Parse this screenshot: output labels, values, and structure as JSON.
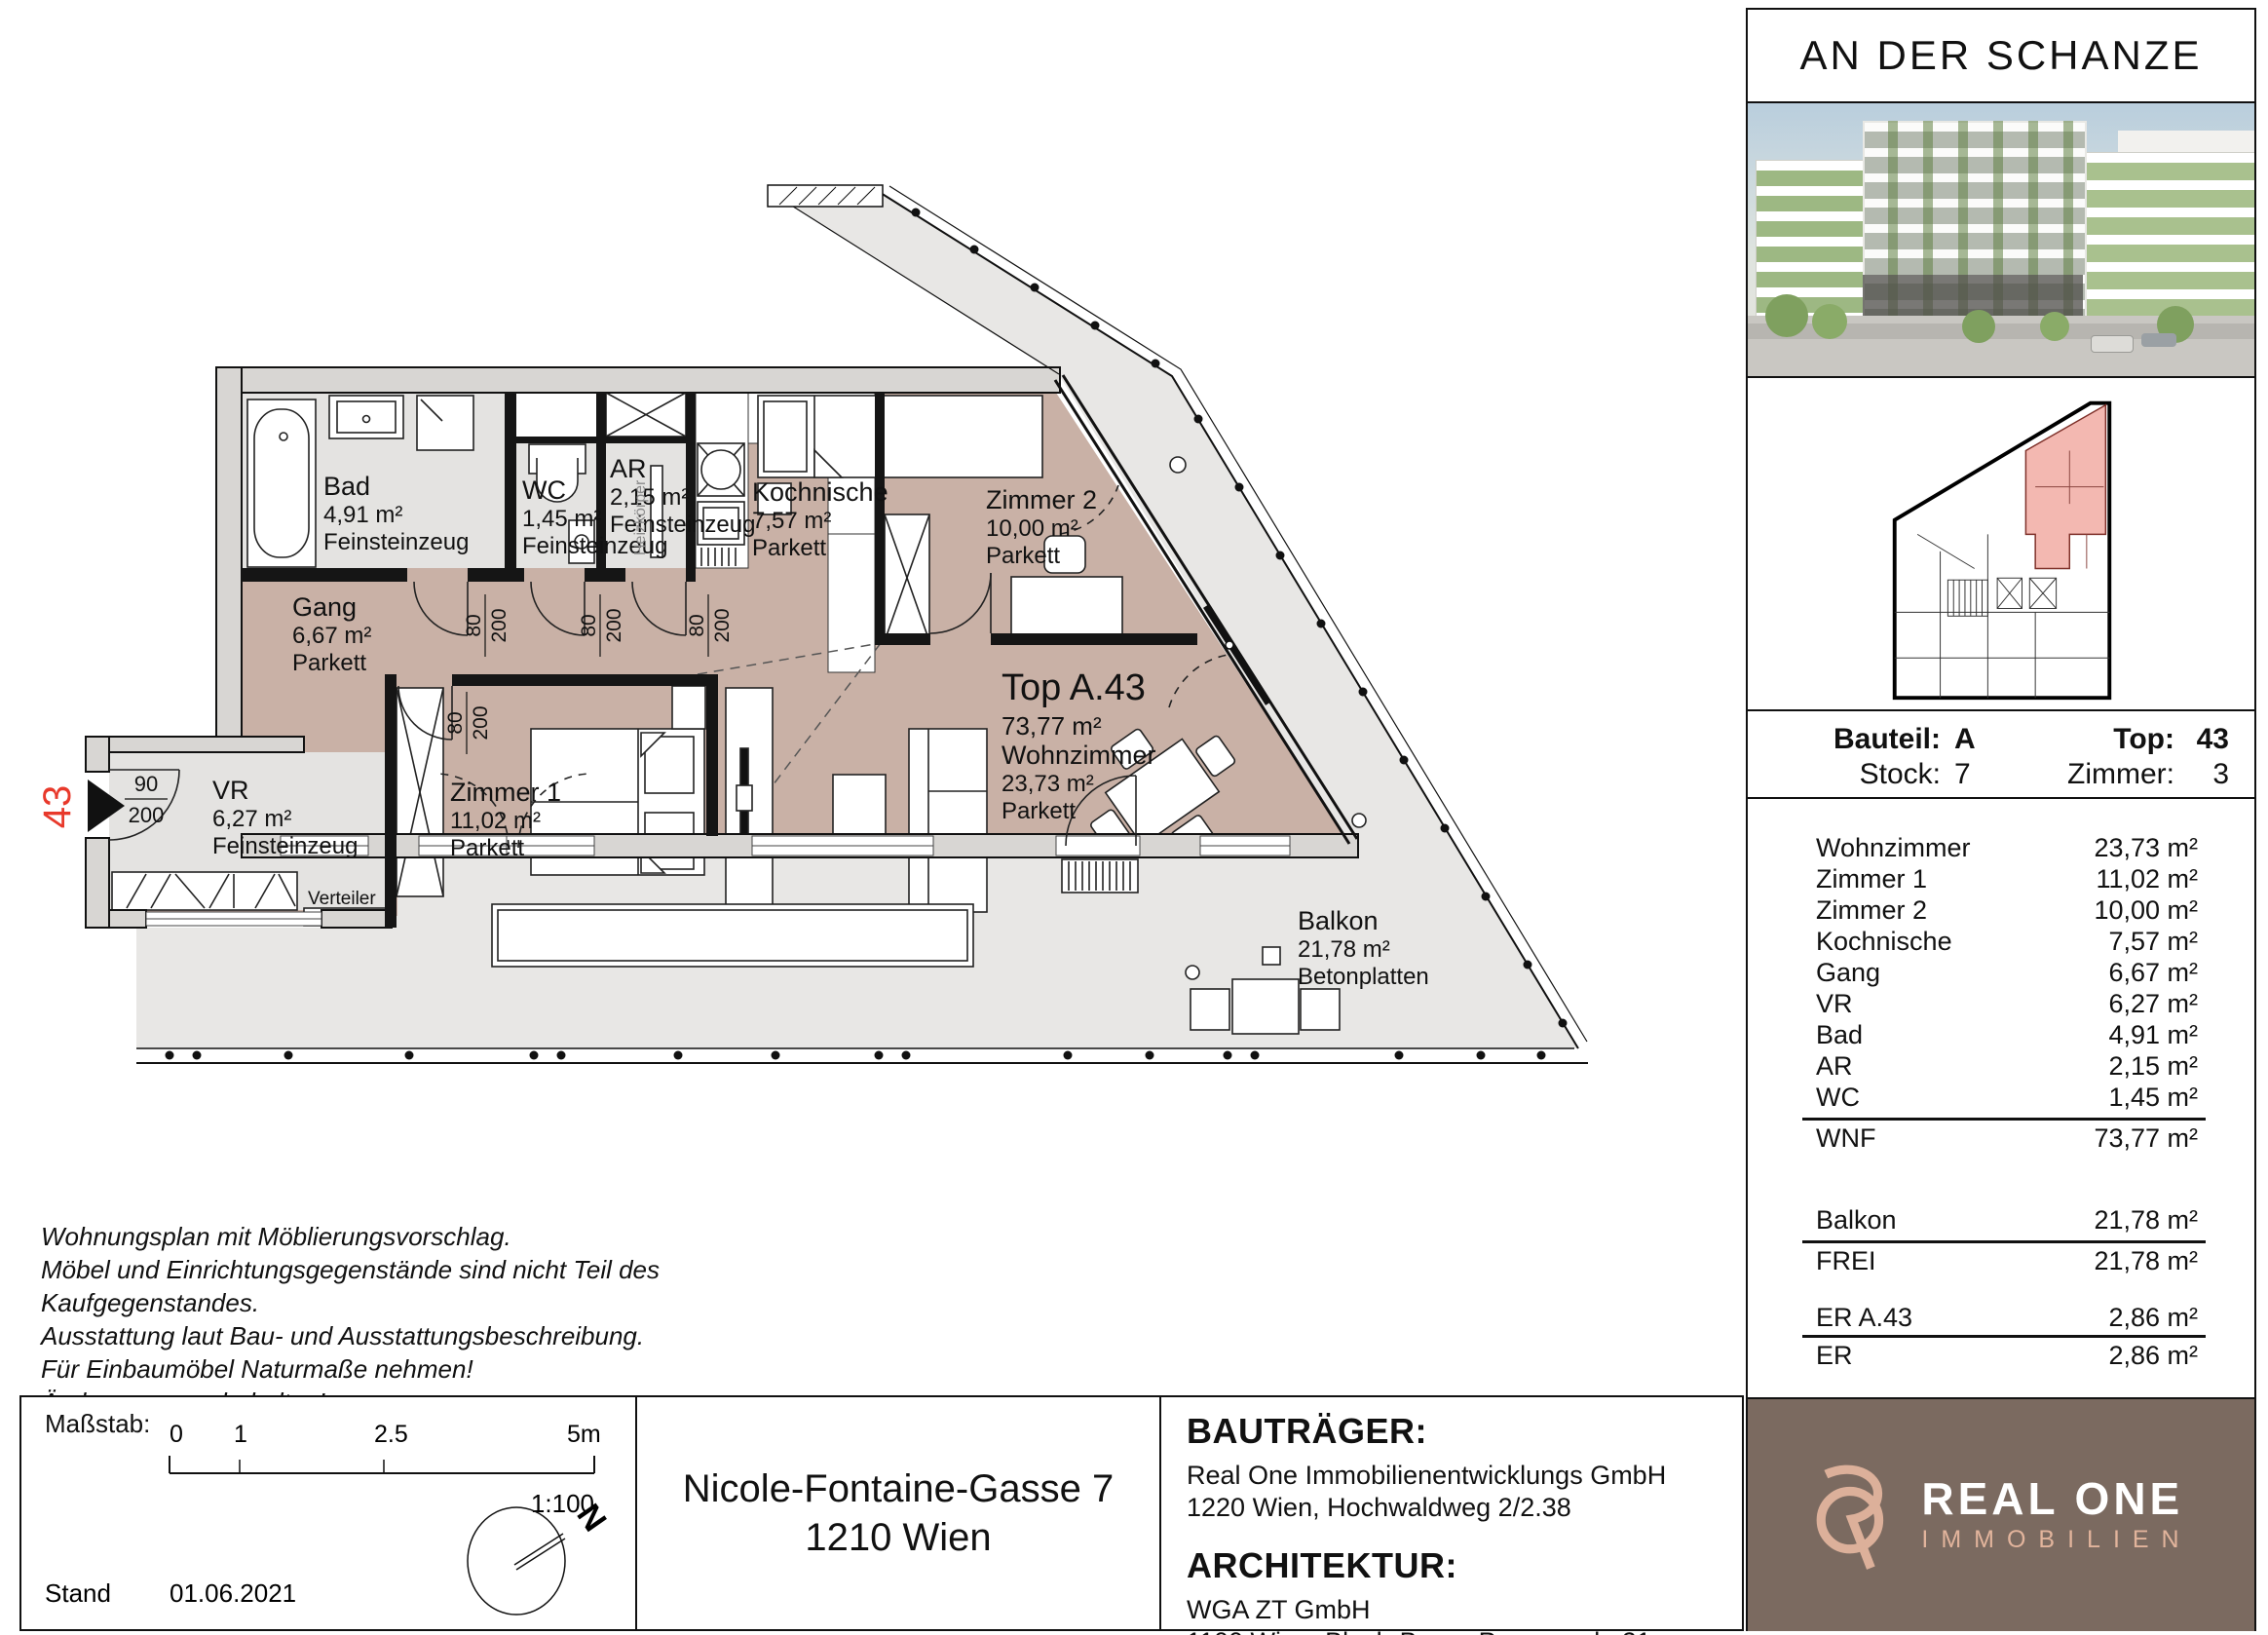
{
  "project": {
    "title": "AN DER SCHANZE"
  },
  "unit_info": {
    "bauteil_label": "Bauteil:",
    "bauteil": "A",
    "top_label": "Top:",
    "top": "43",
    "stock_label": "Stock:",
    "stock": "7",
    "zimmer_label": "Zimmer:",
    "zimmer": "3"
  },
  "area_table": {
    "rows": [
      {
        "label": "Wohnzimmer",
        "value": "23,73 m²"
      },
      {
        "label": "Zimmer 1",
        "value": "11,02 m²"
      },
      {
        "label": "Zimmer 2",
        "value": "10,00 m²"
      },
      {
        "label": "Kochnische",
        "value": "7,57 m²"
      },
      {
        "label": "Gang",
        "value": "6,67 m²"
      },
      {
        "label": "VR",
        "value": "6,27 m²"
      },
      {
        "label": "Bad",
        "value": "4,91 m²"
      },
      {
        "label": "AR",
        "value": "2,15 m²"
      },
      {
        "label": "WC",
        "value": "1,45 m²"
      }
    ],
    "wnf": {
      "label": "WNF",
      "value": "73,77 m²"
    },
    "balkon": {
      "label": "Balkon",
      "value": "21,78 m²"
    },
    "frei": {
      "label": "FREI",
      "value": "21,78 m²"
    },
    "er_a43": {
      "label": "ER A.43",
      "value": "2,86 m²"
    },
    "er": {
      "label": "ER",
      "value": "2,86 m²"
    }
  },
  "logo": {
    "name": "REAL ONE",
    "sub": "IMMOBILIEN"
  },
  "plan": {
    "unit_label": "Top A.43",
    "unit_area": "73,77 m²",
    "rooms": [
      {
        "name": "Bad",
        "area": "4,91 m²",
        "floor": "Feinsteinzeug"
      },
      {
        "name": "WC",
        "area": "1,45 m²",
        "floor": "Feinsteinzeug"
      },
      {
        "name": "AR",
        "area": "2,15 m²",
        "floor": "Feinsteinzeug"
      },
      {
        "name": "Kochnische",
        "area": "7,57 m²",
        "floor": "Parkett"
      },
      {
        "name": "Zimmer 2",
        "area": "10,00 m²",
        "floor": "Parkett"
      },
      {
        "name": "Gang",
        "area": "6,67 m²",
        "floor": "Parkett"
      },
      {
        "name": "VR",
        "area": "6,27 m²",
        "floor": "Feinsteinzeug"
      },
      {
        "name": "Zimmer 1",
        "area": "11,02 m²",
        "floor": "Parkett"
      },
      {
        "name": "Wohnzimmer",
        "area": "23,73 m²",
        "floor": "Parkett"
      },
      {
        "name": "Balkon",
        "area": "21,78 m²",
        "floor": "Betonplatten"
      }
    ],
    "door_80": "80",
    "door_90": "90",
    "door_200": "200",
    "entry_number": "43",
    "heizkoerper_label": "Heizkörper",
    "verteiler_label": "Verteiler"
  },
  "footer": {
    "disclaimer_lines": [
      "Wohnungsplan mit Möblierungsvorschlag.",
      "Möbel und Einrichtungsgegenstände sind nicht Teil des",
      "Kaufgegenstandes.",
      "Ausstattung laut Bau- und Ausstattungsbeschreibung.",
      "Für Einbaumöbel Naturmaße nehmen!",
      "Änderungen vorbehalten!"
    ],
    "massstab_label": "Maßstab:",
    "scale_ticks": [
      "0",
      "1",
      "2.5",
      "5m"
    ],
    "scale_ratio": "1:100",
    "stand_label": "Stand",
    "stand_date": "01.06.2021",
    "north_label": "N",
    "address_line1": "Nicole-Fontaine-Gasse 7",
    "address_line2": "1210 Wien",
    "bautraeger_heading": "BAUTRÄGER:",
    "bautraeger_line1": "Real One Immobilienentwicklungs GmbH",
    "bautraeger_line2": "1220 Wien, Hochwaldweg 2/2.38",
    "architektur_heading": "ARCHITEKTUR:",
    "architektur_line1": "WGA ZT GmbH",
    "architektur_line2": "1100 Wien, Bloch-Bauer-Promenade 21"
  },
  "colors": {
    "parkett": "#c9b1a6",
    "tile": "#e4e3e1",
    "balcony": "#e8e7e5",
    "wall_band": "#d8d6d3",
    "accent_red": "#e8392b",
    "miniplan_red": "#f3b8b1",
    "logo_bg": "#7b6a60",
    "logo_pink": "#e2b49c"
  }
}
